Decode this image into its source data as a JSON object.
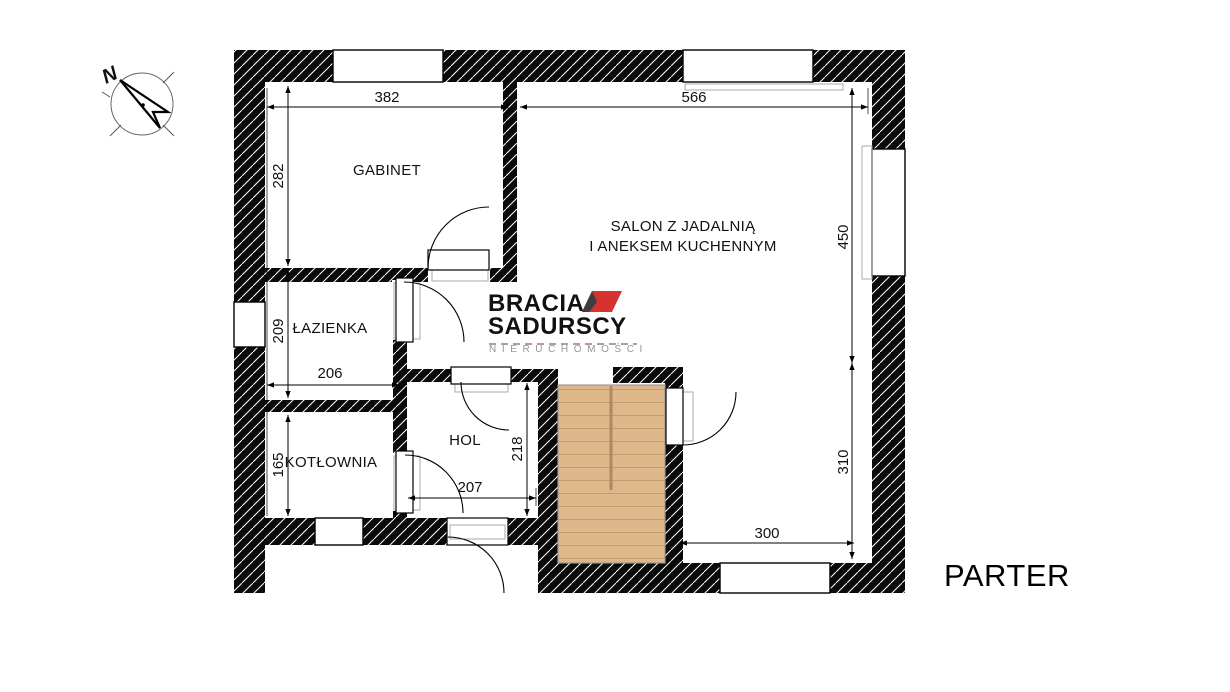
{
  "page": {
    "title": "PARTER"
  },
  "compass": {
    "north_label": "N"
  },
  "watermark": {
    "line1": "BRACIA",
    "line2": "SADURSCY",
    "line3": "NIERUCHOMOŚCI",
    "accent_color": "#d63230",
    "text_color": "#3e3e3e"
  },
  "rooms": {
    "gabinet": {
      "label": "GABINET",
      "width_cm": "382",
      "height_cm": "282"
    },
    "lazienka": {
      "label": "ŁAZIENKA",
      "width_cm": "206",
      "height_cm": "209"
    },
    "kotlownia": {
      "label": "KOTŁOWNIA",
      "height_cm": "165"
    },
    "hol": {
      "label": "HOL",
      "width_cm": "207",
      "height_cm": "218"
    },
    "salon": {
      "label_line1": "SALON Z JADALNIĄ",
      "label_line2": "I ANEKSEM KUCHENNYM",
      "width_cm": "566",
      "upper_height_cm": "450",
      "lower_height_cm": "310",
      "bottom_width_cm": "300"
    }
  },
  "palette": {
    "wall": "#0a0a0a",
    "stairs_fill": "#deb88a",
    "stairs_step_line": "#c49c6e"
  }
}
